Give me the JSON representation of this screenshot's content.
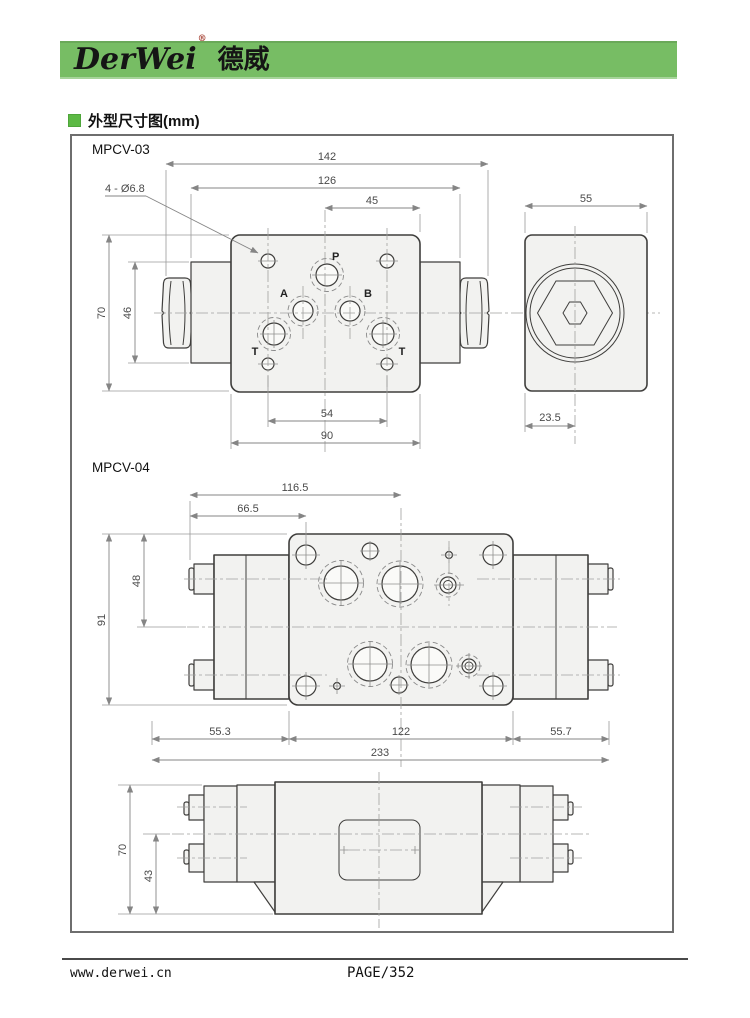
{
  "brand": {
    "name": "DerWei",
    "registered": "®",
    "name_cn": "德威"
  },
  "section": {
    "title": "外型尺寸图(mm)"
  },
  "mpcv03": {
    "label": "MPCV-03",
    "ports": {
      "p": "P",
      "a": "A",
      "b": "B",
      "t1": "T",
      "t2": "T"
    },
    "dims": {
      "width_total": "142",
      "width_body": "126",
      "half_width": "45",
      "mount_holes": "4 - Ø6.8",
      "height": "70",
      "block_height": "46",
      "hole_span": "54",
      "plate_width": "90",
      "side_width": "55",
      "side_offset": "23.5"
    }
  },
  "mpcv04": {
    "label": "MPCV-04",
    "dims": {
      "len_center": "116.5",
      "len_hole": "66.5",
      "height": "91",
      "upper_height": "48",
      "left_len": "55.3",
      "mid_len": "122",
      "right_len": "55.7",
      "total_len": "233",
      "side_height": "70",
      "lower_height": "43"
    }
  },
  "footer": {
    "website": "www.derwei.cn",
    "page": "PAGE/352"
  },
  "colors": {
    "banner_green": "#77bd64",
    "bullet_green": "#5cb944",
    "reg_red": "#a33c2e"
  }
}
